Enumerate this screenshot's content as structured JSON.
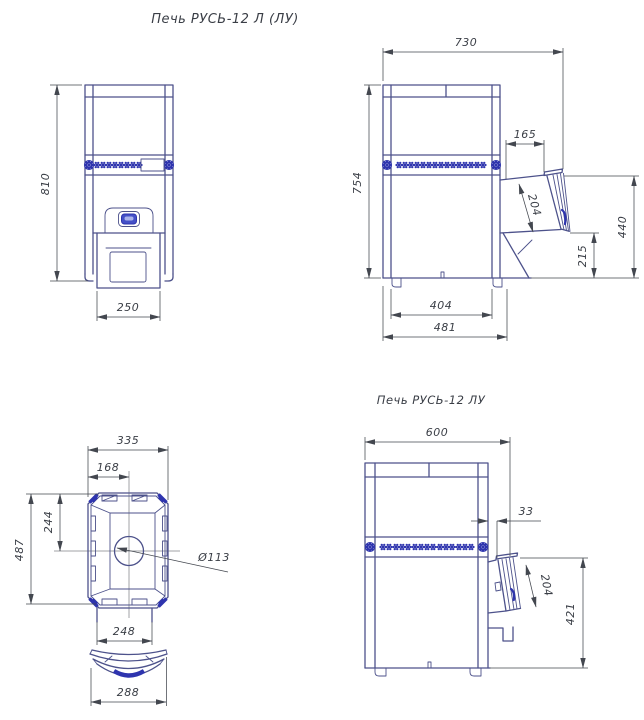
{
  "title": "Печь РУСЬ-12 Л (ЛУ)",
  "colors": {
    "background": "#ffffff",
    "outline": "#4d528b",
    "ornament": "#2e34ae",
    "accent": "#4450c8",
    "dimension": "#43474f",
    "text": "#3a3e46"
  },
  "views": {
    "front": {
      "dims": {
        "height": "810",
        "firebox_width": "250"
      }
    },
    "side": {
      "dims": {
        "overall_depth": "730",
        "body_height": "754",
        "channel_offset": "165",
        "door_face": "204",
        "channel_top_height": "440",
        "channel_bottom_height": "215",
        "base_depth_inner": "404",
        "base_depth_outer": "481"
      }
    },
    "top": {
      "dims": {
        "body_width": "335",
        "chimney_offset": "168",
        "front_to_center": "244",
        "body_depth": "487",
        "chimney_diameter": "Ø113",
        "tunnel_width": "248",
        "frame_width": "288"
      }
    },
    "side_lu": {
      "label": "Печь РУСЬ-12 ЛУ",
      "dims": {
        "overall_depth": "600",
        "channel_offset": "33",
        "door_face": "204",
        "channel_height": "421"
      }
    }
  }
}
